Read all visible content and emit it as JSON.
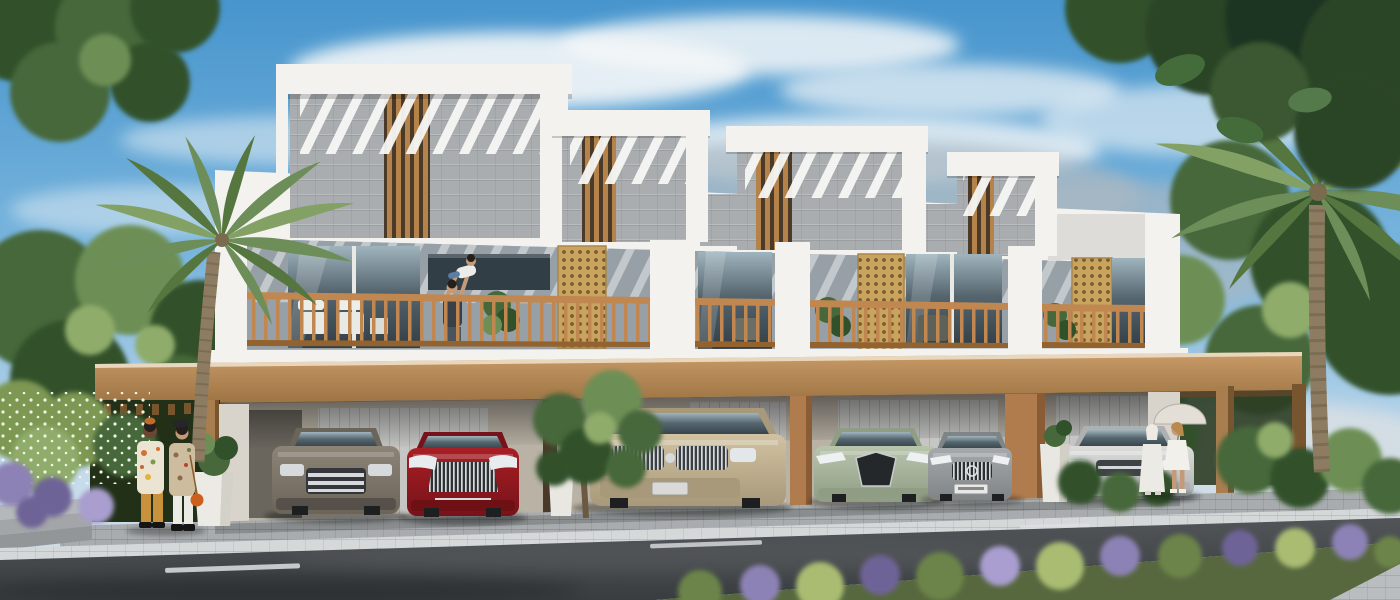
{
  "scene": {
    "domain": "architectural-exterior-render",
    "description": "Sunny 3D rendering of a modern two-storey townhouse row with timber pergolas, stone-clad roof boxes, timber balcony railings, golden mashrabiya screens, a tan canopy over covered parking with six cars, palm trees, landscaped sidewalk and an asphalt road in the foreground",
    "time_of_day": "day",
    "units_visible": 4
  },
  "palette": {
    "skyTop": "#4795cd",
    "skyMid": "#7db7de",
    "skyLow": "#c6dcec",
    "haze": "#d5dee4",
    "cloudWhite": "#f4f7f8",
    "cloudGrey": "#a9b8c2",
    "cloudSteel": "#bcc9d3",
    "white": "#f3f2ef",
    "whiteShade": "#dddcd8",
    "whiteDark": "#c4c3bf",
    "stone": "#a9adb0",
    "stoneDark": "#8f9497",
    "louverBase": "#4a3a29",
    "louverWood": "#b5834a",
    "wallGrey": "#97a0a6",
    "wallGreyDark": "#7e878d",
    "railWood": "#c08850",
    "railWoodDark": "#92632f",
    "fasciaLight": "#c99c68",
    "fasciaDark": "#9d7343",
    "fasciaEdge": "#e9d7bd",
    "fasciaUnder": "#5e452a",
    "postWood": "#a97e4f",
    "postWoodDark": "#77552f",
    "glassDark": "#323e46",
    "glassMid": "#55656e",
    "glassLight": "#9fb4bd",
    "lattice": "#c9a45e",
    "latticeDark": "#7a5a2e",
    "groundWall": "#b9b2a5",
    "groundWallDark": "#978f82",
    "garageDoor": "#c6c7c5",
    "pillarTan": "#b07c4e",
    "pillarTanDark": "#8a5c36",
    "darkPost": "#4a3828",
    "endWhite": "#d8d4cb",
    "apron": "#a8acae",
    "sidewalk": "#d5d8d9",
    "pavers": "#b9bdbf",
    "roadLight": "#515558",
    "roadDark": "#393d40",
    "laneWhite": "#dde0e1",
    "treeDark": "#31512a",
    "treeMid": "#47683a",
    "treeLight": "#6d8f55",
    "treeSage": "#8fac6b",
    "palmGreen": "#6d8d59",
    "palmDark": "#55763f",
    "palmLight": "#83a164",
    "palmTrunk": "#8d7c62",
    "palmTrunkDark": "#6e5e48",
    "hedge": "#7d9853",
    "flowerWhite": "#f1f2e6",
    "flowerPurple": "#8d82b5",
    "flowerPurpleLight": "#a99ecf",
    "flowerPurpleDark": "#6e6396",
    "bedGreen": "#6c8448",
    "bedLight": "#a9bc72",
    "bedBase": "#57683f",
    "carGrey": "#8d8478",
    "carGreyDark": "#6b6458",
    "carRed": "#a81f24",
    "carRedDark": "#77121a",
    "carBeige": "#d1c2a2",
    "carBeigeDark": "#a8997a",
    "carSage": "#b9c4ad",
    "carSageDark": "#8f9d85",
    "carSilver": "#a6a9ac",
    "carSilverDark": "#7f8487",
    "carWhite": "#dcdddb",
    "carWhiteDark": "#aeb1b1",
    "chrome": "#d6dadd",
    "tire": "#1d1f21",
    "carGlass": "#3c464c",
    "skin": "#c59a78",
    "skinDark": "#6b4632",
    "hairDark": "#241f1a",
    "shirtCream": "#ece4d2",
    "pantsMustard": "#c8923c",
    "jacketTan": "#cdbd9e",
    "denim": "#5b7ca3",
    "outfitWhite": "#eceae4",
    "bagOrange": "#cc5f1e",
    "parasol": "#e3ded6"
  },
  "building": {
    "storeys": 2,
    "unit_count": 4,
    "features": [
      "timber pergola roof slats",
      "grey stone clad parapet boxes",
      "vertical timber louvers",
      "timber balcony railings",
      "golden mashrabiya lattice screens",
      "full-width tan canopy band",
      "covered parking bays",
      "balcony planters and seating"
    ],
    "materials": [
      "white render",
      "grey stone",
      "warm timber",
      "glass"
    ]
  },
  "vehicles": [
    {
      "id": "vehicle-1",
      "type": "suv",
      "color_name": "grey-brown",
      "color": "#8d8478"
    },
    {
      "id": "vehicle-2",
      "type": "sedan",
      "color_name": "red",
      "color": "#a81f24"
    },
    {
      "id": "vehicle-3",
      "type": "suv",
      "color_name": "champagne-beige",
      "color": "#d1c2a2"
    },
    {
      "id": "vehicle-4",
      "type": "sedan",
      "color_name": "sage-green",
      "color": "#b9c4ad"
    },
    {
      "id": "vehicle-5",
      "type": "sedan",
      "color_name": "silver",
      "color": "#a6a9ac"
    },
    {
      "id": "vehicle-6",
      "type": "suv",
      "color_name": "white",
      "color": "#dcdddb"
    }
  ],
  "people": [
    {
      "id": "couple-left",
      "count": 2,
      "description": "man in patterned shirt with mustard trousers talking to woman in beret, floral jacket, white jeans and orange bag"
    },
    {
      "id": "family-balcony",
      "count": 2,
      "description": "parent lifting a child on the first unit balcony"
    },
    {
      "id": "women-right",
      "count": 2,
      "description": "two women dressed in white, one holding a parasol, walking past the parking bays"
    }
  ],
  "vegetation": {
    "palm_trees": 2,
    "street_trees": "leafy tree in front of middle parking bay, large trees framing both top corners",
    "planters": 3,
    "hedges": "white flowering hedge at lower left",
    "flower_bed": "purple and green groundcover strip along the near road edge"
  },
  "road": {
    "surface": "dark asphalt",
    "lane_dashes": 3,
    "sidewalk": "light paver band with white curb",
    "apron": "grey cobble parking apron"
  },
  "sky": {
    "clouds": "soft white and grey clouds",
    "color_top": "#4795cd"
  }
}
